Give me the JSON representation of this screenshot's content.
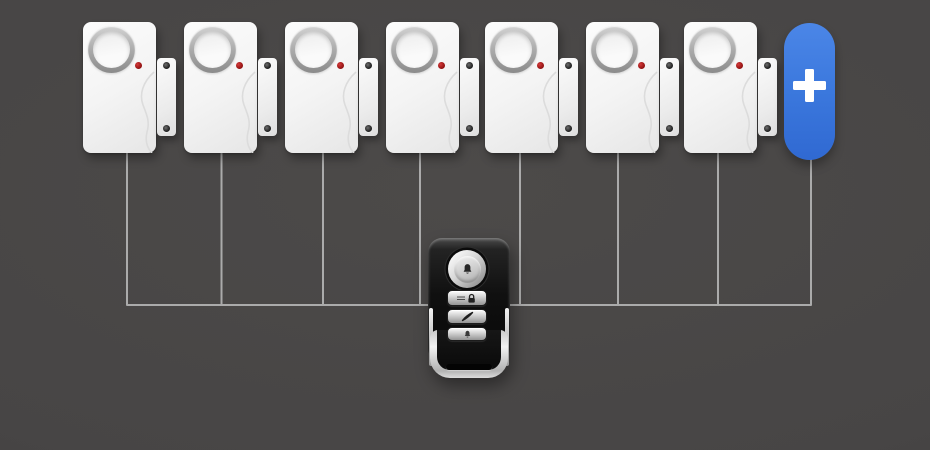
{
  "scene": {
    "background_color": "#474545",
    "wire_color": "#ababab"
  },
  "sensors": {
    "count": 7,
    "body_color": "#f4f4f4",
    "speaker_icon": "siren-speaker",
    "led_color": "#b11212"
  },
  "add_button": {
    "label": "+",
    "color": "#3b78dd",
    "icon": "plus-icon"
  },
  "remote": {
    "body_color": "#101010",
    "buttons": [
      {
        "name": "arm",
        "icon": "alarm-bell-icon"
      },
      {
        "name": "lock",
        "icon": "lock-icon"
      },
      {
        "name": "panic",
        "icon": "lightning-icon"
      },
      {
        "name": "chime",
        "icon": "bell-icon"
      }
    ]
  }
}
